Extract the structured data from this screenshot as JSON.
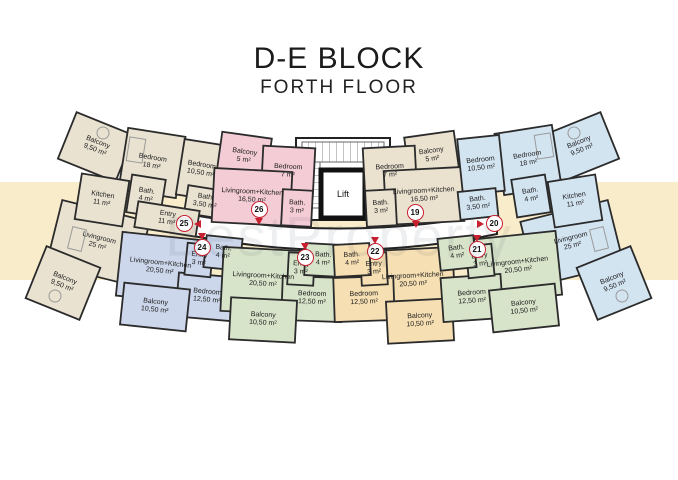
{
  "title": "D-E BLOCK",
  "subtitle": "FORTH FLOOR",
  "watermark": "BestProperty",
  "core": {
    "lift_label": "Lift"
  },
  "colors": {
    "accent_red": "#c8202f",
    "band_yellow": "#f8ecca",
    "wall": "#2b2b2b"
  },
  "apartments": [
    {
      "number": "25",
      "color": "#e9e2d1",
      "rooms": [
        {
          "name": "Balcony",
          "area": "9,50 m²"
        },
        {
          "name": "Bedroom",
          "area": "18 m²"
        },
        {
          "name": "Bedroom",
          "area": "10,50 m²"
        },
        {
          "name": "Kitchen",
          "area": "11 m²"
        },
        {
          "name": "Bath.",
          "area": "4 m²"
        },
        {
          "name": "Bath.",
          "area": "3,50 m²"
        },
        {
          "name": "Entry",
          "area": "11 m²"
        },
        {
          "name": "Livingroom",
          "area": "25 m²"
        },
        {
          "name": "Balcony",
          "area": "9,50 m²"
        }
      ]
    },
    {
      "number": "26",
      "color": "#f3ccd6",
      "rooms": [
        {
          "name": "Balcony",
          "area": "5 m²"
        },
        {
          "name": "Bedroom",
          "area": "7 m²"
        },
        {
          "name": "Livingroom+Kitchen",
          "area": "16,50 m²"
        },
        {
          "name": "Bath.",
          "area": "3 m²"
        }
      ]
    },
    {
      "number": "19",
      "color": "#eae1cf",
      "rooms": [
        {
          "name": "Balcony",
          "area": "5 m²"
        },
        {
          "name": "Bedroom",
          "area": "7 m²"
        },
        {
          "name": "Livingroom+Kitchen",
          "area": "16,50 m²"
        },
        {
          "name": "Bath.",
          "area": "3 m²"
        }
      ]
    },
    {
      "number": "20",
      "color": "#d3e4f1",
      "rooms": [
        {
          "name": "Balcony",
          "area": "9,50 m²"
        },
        {
          "name": "Bedroom",
          "area": "18 m²"
        },
        {
          "name": "Bedroom",
          "area": "10,50 m²"
        },
        {
          "name": "Kitchen",
          "area": "11 m²"
        },
        {
          "name": "Bath.",
          "area": "4 m²"
        },
        {
          "name": "Bath.",
          "area": "3,50 m²"
        },
        {
          "name": "Livingroom",
          "area": "25 m²"
        },
        {
          "name": "Balcony",
          "area": "9,50 m²"
        }
      ]
    },
    {
      "number": "24",
      "color": "#ccd7eb",
      "rooms": [
        {
          "name": "Livingroom+Kitchen",
          "area": "20,50 m²"
        },
        {
          "name": "Entry",
          "area": "3 m²"
        },
        {
          "name": "Bath.",
          "area": "4 m²"
        },
        {
          "name": "Bedroom",
          "area": "12,50 m²"
        },
        {
          "name": "Balcony",
          "area": "10,50 m²"
        }
      ]
    },
    {
      "number": "23",
      "color": "#d7e4ca",
      "rooms": [
        {
          "name": "Livingroom+Kitchen",
          "area": "20,50 m²"
        },
        {
          "name": "Entry",
          "area": "3 m²"
        },
        {
          "name": "Bath.",
          "area": "4 m²"
        },
        {
          "name": "Bedroom",
          "area": "12,50 m²"
        },
        {
          "name": "Balcony",
          "area": "10,50 m²"
        }
      ]
    },
    {
      "number": "22",
      "color": "#f6dfb3",
      "rooms": [
        {
          "name": "Livingroom+Kitchen",
          "area": "20,50 m²"
        },
        {
          "name": "Entry",
          "area": "3 m²"
        },
        {
          "name": "Bath.",
          "area": "4 m²"
        },
        {
          "name": "Bedroom",
          "area": "12,50 m²"
        },
        {
          "name": "Balcony",
          "area": "10,50 m²"
        }
      ]
    },
    {
      "number": "21",
      "color": "#d7e4ca",
      "rooms": [
        {
          "name": "Livingroom+Kitchen",
          "area": "20,50 m²"
        },
        {
          "name": "Entry",
          "area": "3 m²"
        },
        {
          "name": "Bath.",
          "area": "4 m²"
        },
        {
          "name": "Bedroom",
          "area": "12,50 m²"
        },
        {
          "name": "Balcony",
          "area": "10,50 m²"
        }
      ]
    }
  ]
}
